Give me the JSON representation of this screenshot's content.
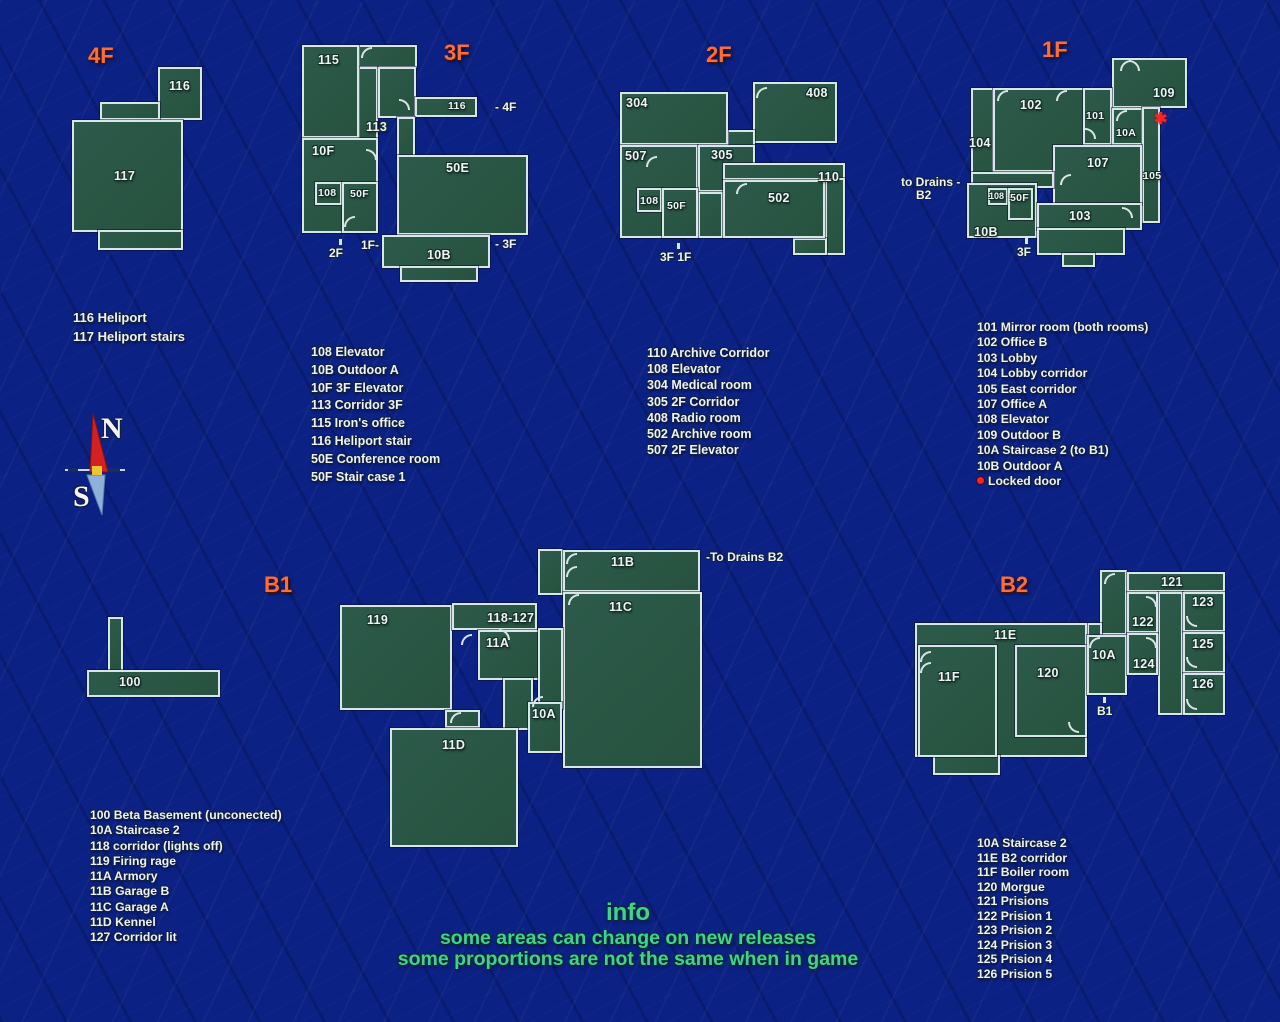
{
  "floors": [
    {
      "title": "4F",
      "rooms": [
        "116",
        "117"
      ],
      "legend": [
        "116 Heliport",
        "117 Heliport stairs"
      ],
      "annotations": []
    },
    {
      "title": "3F",
      "rooms": [
        "115",
        "113",
        "116",
        "10F",
        "108",
        "50F",
        "50E",
        "10B"
      ],
      "legend": [
        "108 Elevator",
        "10B Outdoor A",
        "10F 3F Elevator",
        "113 Corridor 3F",
        "115 Iron's office",
        "116 Heliport stair",
        "50E Conference room",
        "50F Stair case 1"
      ],
      "annotations": [
        "- 4F",
        "2F",
        "1F-",
        "- 3F"
      ]
    },
    {
      "title": "2F",
      "rooms": [
        "304",
        "408",
        "507",
        "305",
        "110",
        "502",
        "108",
        "50F"
      ],
      "legend": [
        "110 Archive Corridor",
        "108 Elevator",
        "304 Medical room",
        "305 2F Corridor",
        "408 Radio room",
        "502 Archive room",
        "507 2F Elevator"
      ],
      "annotations": [
        "3F 1F"
      ]
    },
    {
      "title": "1F",
      "rooms": [
        "102",
        "101",
        "109",
        "104",
        "10A",
        "107",
        "105",
        "108",
        "50F",
        "103",
        "10B"
      ],
      "legend": [
        "101 Mirror room (both rooms)",
        "102 Office B",
        "103 Lobby",
        "104 Lobby corridor",
        "105 East corridor",
        "107 Office A",
        "108 Elevator",
        "109 Outdoor B",
        "10A Staircase 2 (to B1)",
        "10B Outdoor A"
      ],
      "locked_label": "Locked door",
      "annotations": [
        "to Drains -",
        "B2",
        "3F",
        "✱"
      ]
    },
    {
      "title": "B1",
      "rooms": [
        "100",
        "119",
        "118-127",
        "11A",
        "11B",
        "11C",
        "10A",
        "11D"
      ],
      "legend": [
        "100 Beta Basement (unconected)",
        "10A Staircase 2",
        "118 corridor (lights off)",
        "119 Firing rage",
        "11A Armory",
        "11B Garage B",
        "11C Garage A",
        "11D Kennel",
        "127 Corridor lit"
      ],
      "annotations": [
        "-To Drains B2"
      ]
    },
    {
      "title": "B2",
      "rooms": [
        "11E",
        "11F",
        "120",
        "10A",
        "121",
        "122",
        "123",
        "124",
        "125",
        "126"
      ],
      "legend": [
        "10A Staircase 2",
        "11E B2 corridor",
        "11F Boiler room",
        "120 Morgue",
        "121 Prisions",
        "122 Prision 1",
        "123 Prision 2",
        "124 Prision 3",
        "125 Prision 4",
        "126 Prision 5"
      ],
      "annotations": [
        "B1"
      ]
    }
  ],
  "info": {
    "title": "info",
    "line1": "some areas can change on new releases",
    "line2": "some proportions are not the same when in game"
  },
  "compass": {
    "north": "N",
    "south": "S"
  },
  "colors": {
    "background": "#0b2183",
    "room_fill": "#2a5747",
    "room_border": "#d9e6e7",
    "floor_title": "#ff6d35",
    "info_green": "#3dd48c",
    "locked_red": "#ff2222"
  }
}
